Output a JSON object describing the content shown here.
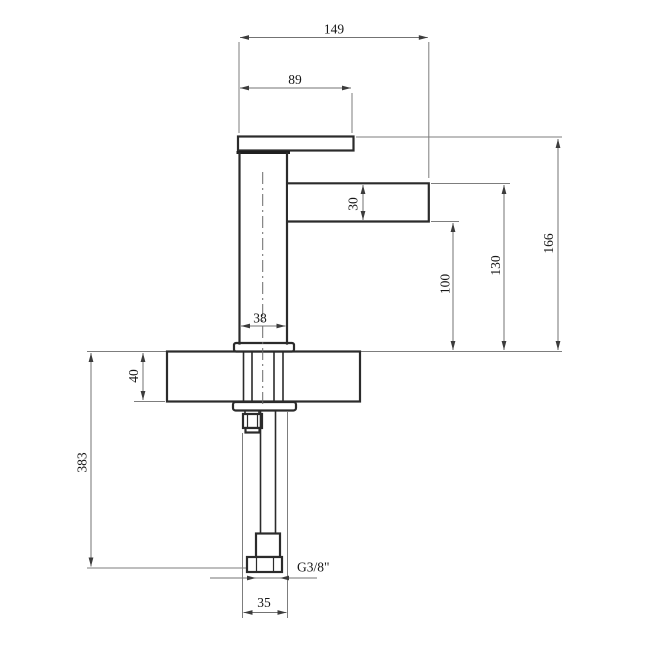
{
  "drawing": {
    "type": "technical-dimension-drawing",
    "subject": "single-lever basin tap, side elevation with mounting deck and supply pipe",
    "colors": {
      "background": "#ffffff",
      "object_line": "#2b2b2b",
      "dimension_line": "#737373",
      "text": "#161616"
    },
    "dimensions": {
      "overall_depth": "149",
      "handle_length": "89",
      "spout_section_height": "30",
      "overall_height_above_deck": "166",
      "spout_top_height": "130",
      "spout_underside_height": "100",
      "body_width": "38",
      "deck_thickness": "40",
      "below_deck_length": "383",
      "connection_width": "35",
      "thread_size": "G3/8\""
    }
  }
}
